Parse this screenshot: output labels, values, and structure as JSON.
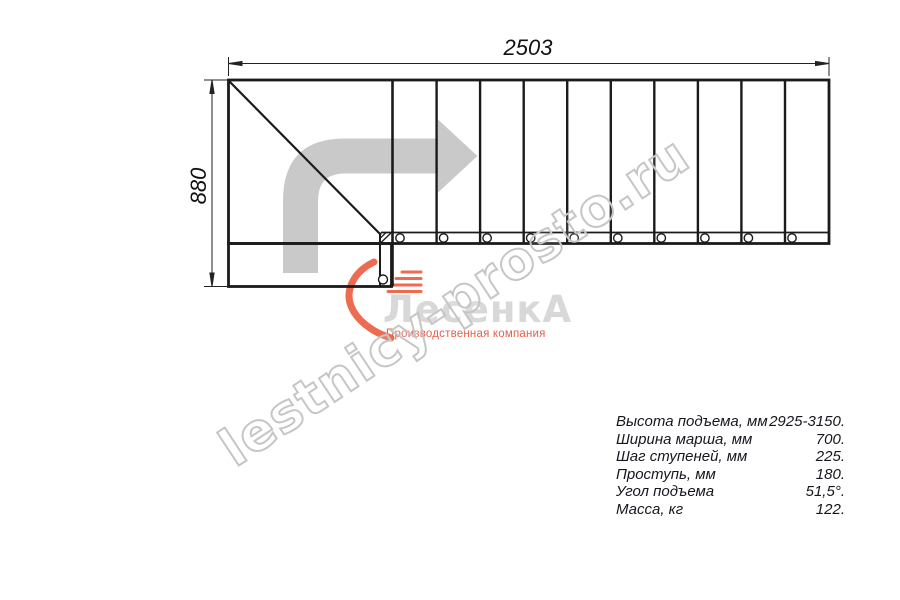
{
  "drawing": {
    "dim_width_label": "2503",
    "dim_height_label": "880",
    "line_color": "#1b1b1b",
    "arrow_color": "#c9c9c9"
  },
  "watermark": {
    "text": "lestnicy-prosto.ru",
    "color": "#c6c6c6"
  },
  "logo": {
    "name": "ЛесенкА",
    "subtitle": "Производственная компания",
    "text_color": "#d8d8d8",
    "accent_color": "#e4604d"
  },
  "specs": {
    "rows": [
      {
        "label": "Высота подъема, мм",
        "value": "2925-3150."
      },
      {
        "label": "Ширина марша, мм",
        "value": "700."
      },
      {
        "label": "Шаг ступеней, мм",
        "value": "225."
      },
      {
        "label": "Проступь, мм",
        "value": "180."
      },
      {
        "label": "Угол подъема",
        "value": "51,5°."
      },
      {
        "label": "Масса, кг",
        "value": "122."
      }
    ]
  }
}
